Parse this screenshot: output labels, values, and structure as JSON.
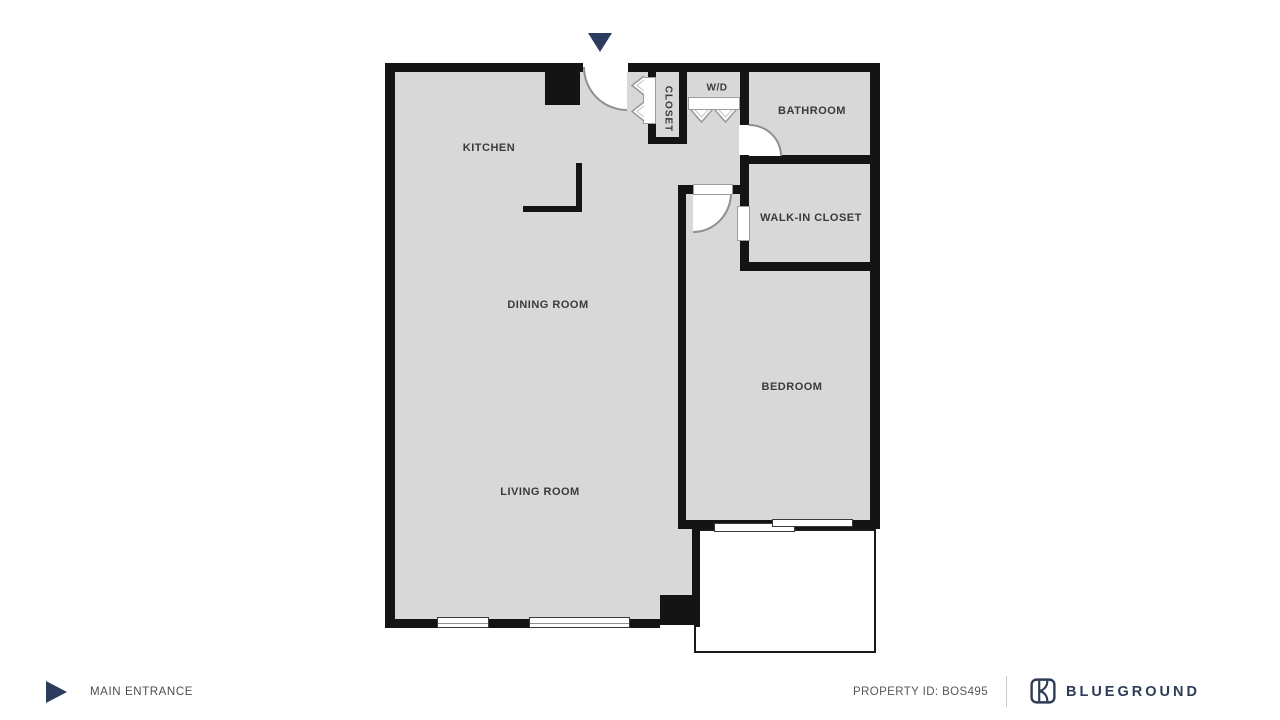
{
  "floorplan": {
    "rooms": {
      "kitchen": {
        "label": "KITCHEN"
      },
      "dining": {
        "label": "DINING ROOM"
      },
      "living": {
        "label": "LIVING ROOM"
      },
      "bedroom": {
        "label": "BEDROOM"
      },
      "bathroom": {
        "label": "BATHROOM"
      },
      "walkin": {
        "label": "WALK-IN CLOSET"
      },
      "closet": {
        "label": "CLOSET"
      },
      "wd": {
        "label": "W/D"
      }
    },
    "colors": {
      "floor": "#d8d8d8",
      "wall": "#141414",
      "door_arc": "#8f8f8f",
      "accent_navy": "#2c3c5e"
    }
  },
  "footer": {
    "entrance_label": "MAIN ENTRANCE",
    "property_id_label": "PROPERTY ID: BOS495",
    "brand": "BLUEGROUND"
  }
}
